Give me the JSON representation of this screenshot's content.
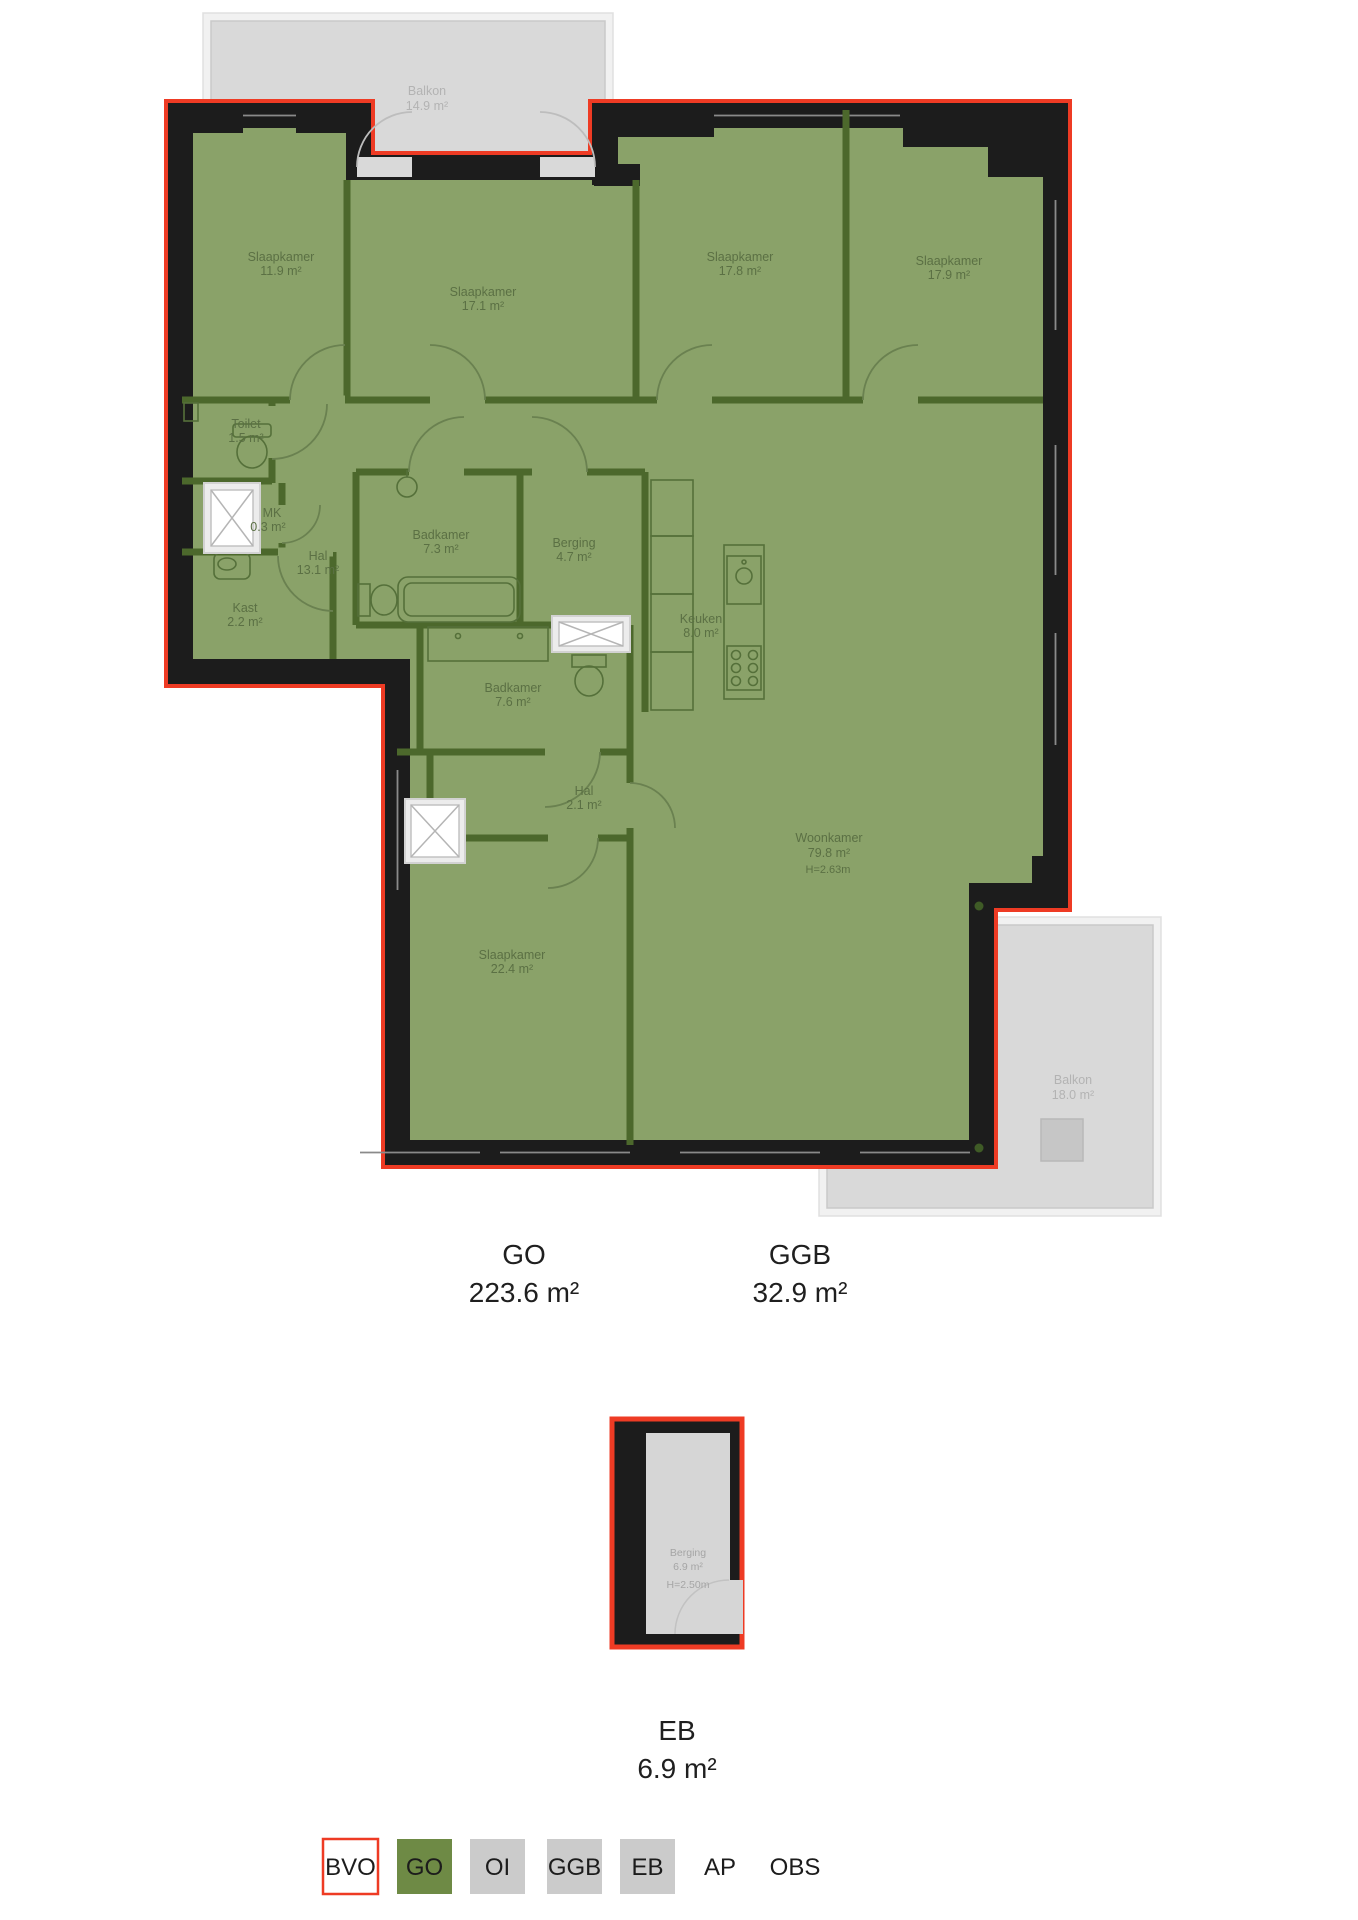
{
  "plan": {
    "balkon_top": {
      "name": "Balkon",
      "area": "14.9 m²"
    },
    "balkon_bottom": {
      "name": "Balkon",
      "area": "18.0 m²"
    },
    "rooms": {
      "slaapkamer1": {
        "name": "Slaapkamer",
        "area": "11.9 m²"
      },
      "slaapkamer2": {
        "name": "Slaapkamer",
        "area": "17.1 m²"
      },
      "slaapkamer3": {
        "name": "Slaapkamer",
        "area": "17.8 m²"
      },
      "slaapkamer4": {
        "name": "Slaapkamer",
        "area": "17.9 m²"
      },
      "toilet": {
        "name": "Toilet",
        "area": "1.5 m²"
      },
      "mk": {
        "name": "MK",
        "area": "0.3 m²"
      },
      "hal1": {
        "name": "Hal",
        "area": "13.1 m²"
      },
      "kast": {
        "name": "Kast",
        "area": "2.2 m²"
      },
      "badkamer1": {
        "name": "Badkamer",
        "area": "7.3 m²"
      },
      "berging": {
        "name": "Berging",
        "area": "4.7 m²"
      },
      "keuken": {
        "name": "Keuken",
        "area": "8.0 m²"
      },
      "badkamer2": {
        "name": "Badkamer",
        "area": "7.6 m²"
      },
      "hal2": {
        "name": "Hal",
        "area": "2.1 m²"
      },
      "woonkamer": {
        "name": "Woonkamer",
        "area": "79.8 m²",
        "height": "H=2.63m"
      },
      "slaapkamer5": {
        "name": "Slaapkamer",
        "area": "22.4 m²"
      },
      "eb_berging": {
        "name": "Berging",
        "area": "6.9 m²",
        "height": "H=2.50m"
      }
    },
    "totals": {
      "go": {
        "label": "GO",
        "value": "223.6 m²"
      },
      "ggb": {
        "label": "GGB",
        "value": "32.9 m²"
      },
      "eb": {
        "label": "EB",
        "value": "6.9 m²"
      }
    }
  },
  "legend": {
    "items": [
      {
        "label": "BVO",
        "fill": "#ffffff",
        "stroke": "#ee3b24"
      },
      {
        "label": "GO",
        "fill": "#6e8a45",
        "stroke": "none"
      },
      {
        "label": "OI",
        "fill": "#cbcbcb",
        "stroke": "none"
      },
      {
        "label": "GGB",
        "fill": "#cbcbcb",
        "stroke": "none"
      },
      {
        "label": "EB",
        "fill": "#cbcbcb",
        "stroke": "none"
      },
      {
        "label": "AP",
        "fill": "none",
        "stroke": "none"
      },
      {
        "label": "OBS",
        "fill": "none",
        "stroke": "none"
      }
    ]
  },
  "colors": {
    "floor_green": "#8aa269",
    "interior_wall": "#4c682c",
    "exterior_wall": "#1c1c1c",
    "bvo_red": "#ee3b24",
    "balcony_fill": "#d9d9d9",
    "legend_gray": "#cbcbcb",
    "room_text": "#5b7044",
    "balcony_text": "#b3b3b3"
  }
}
